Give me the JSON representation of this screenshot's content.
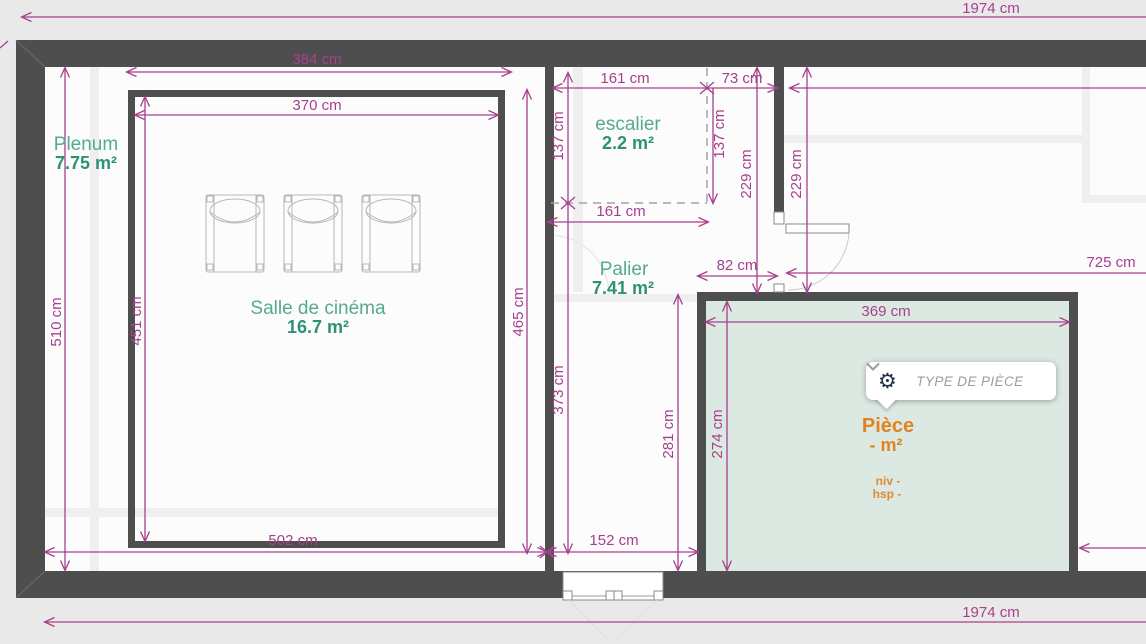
{
  "app": {
    "view": "floor-plan-editor"
  },
  "dims": {
    "top_total": "1974 cm",
    "bottom_total": "1974 cm",
    "d384": "384 cm",
    "d370": "370 cm",
    "d161_top": "161 cm",
    "d161_mid": "161 cm",
    "d73": "73 cm",
    "d82": "82 cm",
    "d137_left": "137 cm",
    "d137_right": "137 cm",
    "d229_left": "229 cm",
    "d229_right": "229 cm",
    "d725": "725 cm",
    "d510": "510 cm",
    "d451": "451 cm",
    "d465": "465 cm",
    "d373": "373 cm",
    "d281": "281 cm",
    "d274": "274 cm",
    "d152": "152 cm",
    "d502": "502 cm",
    "d369": "369 cm"
  },
  "rooms": {
    "plenum": {
      "name": "Plenum",
      "area": "7.75 m²"
    },
    "cinema": {
      "name": "Salle de cinéma",
      "area": "16.7 m²"
    },
    "escalier": {
      "name": "escalier",
      "area": "2.2 m²"
    },
    "palier": {
      "name": "Palier",
      "area": "7.41 m²"
    },
    "piece": {
      "name": "Pièce",
      "area": "- m²",
      "niv": "niv -",
      "hsp": "hsp -"
    }
  },
  "popup": {
    "label": "TYPE DE PIÈCE",
    "gear_glyph": "⚙",
    "icons": {
      "gear": "gear-icon",
      "chevron": "chevron-down-icon"
    }
  },
  "colors": {
    "dimension": "#a6408d",
    "wall": "#4e4e4e",
    "room_label": "#2d9177",
    "selected_room_label": "#e2831f",
    "selected_room_fill": "#dce8e2",
    "background": "#e9e9e9"
  }
}
